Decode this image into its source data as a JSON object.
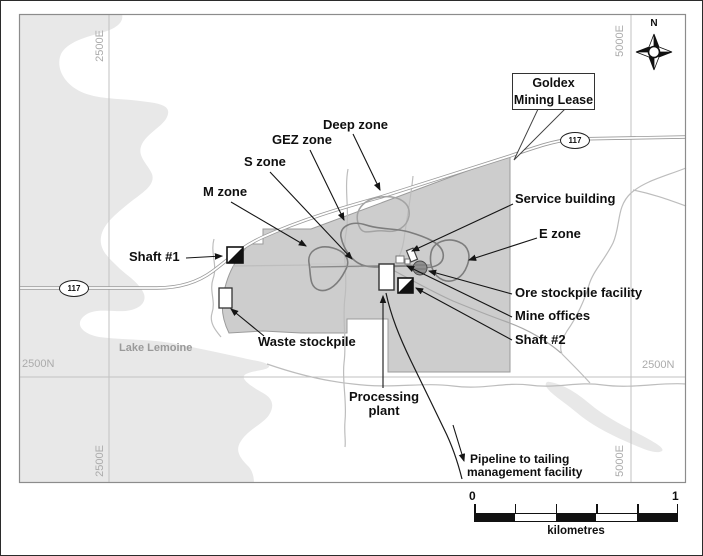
{
  "figure": {
    "title": "Goldex mine site location map",
    "grid": {
      "top_left_easting": "2500E",
      "top_right_easting": "5000E",
      "bottom_left_easting": "2500E",
      "bottom_right_easting": "5000E",
      "left_northing": "2500N",
      "right_northing": "2500N"
    },
    "compass": {
      "north": "N"
    },
    "lease_callout": {
      "line1": "Goldex",
      "line2": "Mining Lease"
    },
    "highway_shield": "117",
    "labels": {
      "deep_zone": "Deep zone",
      "gez_zone": "GEZ zone",
      "s_zone": "S zone",
      "m_zone": "M zone",
      "shaft_1": "Shaft #1",
      "service_building": "Service building",
      "e_zone": "E zone",
      "ore_stockpile_facility": "Ore stockpile facility",
      "mine_offices": "Mine offices",
      "shaft_2": "Shaft #2",
      "waste_stockpile": "Waste stockpile",
      "lake": "Lake Lemoine",
      "processing_plant": [
        "Processing",
        "plant"
      ],
      "pipeline": [
        "Pipeline to tailing",
        "management facility"
      ]
    },
    "scale_bar": {
      "min": "0",
      "max": "1",
      "units": "kilometres"
    },
    "colors": {
      "lake_fill": "#e8e8e8",
      "lease_fill": "#cdcdcd",
      "lease_edge": "#9b9b9b",
      "zone_outline": "#7d7d7d",
      "deep_zone_outline": "#a3a3a3",
      "grid_line": "#c2c2c2",
      "frame": "#8c8c8c",
      "road_casing": "#9a9a9a",
      "trail": "#bdbdbd",
      "label_gray": "#ababab",
      "ink": "#111111"
    }
  }
}
